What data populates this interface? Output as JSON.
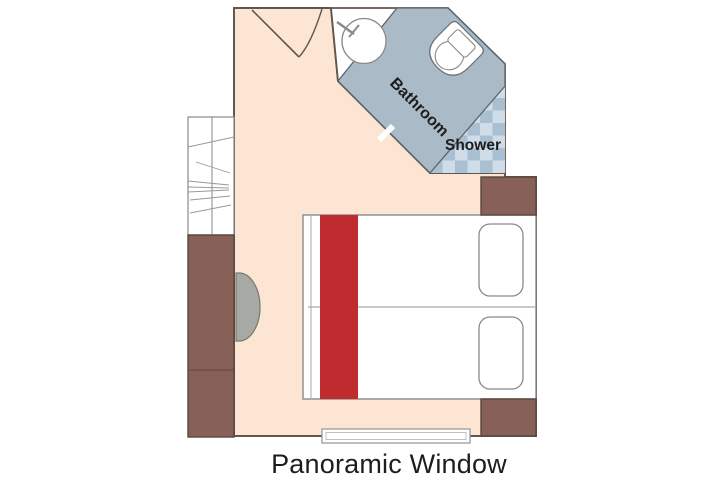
{
  "diagram": {
    "type": "cabin-floor-plan",
    "labels": {
      "bathroom": "Bathroom",
      "shower": "Shower",
      "window": "Panoramic Window"
    },
    "colors": {
      "background": "#ffffff",
      "floor": "#fce5d3",
      "bathroom_floor": "#aabbc7",
      "shower_tile_light": "#cfdde9",
      "shower_tile_dark": "#a9c0d3",
      "furniture_brown": "#876158",
      "bed_runner_red": "#bf2b2e",
      "bed_fill": "#ffffff",
      "stool_gray": "#a7a9a4",
      "wall_stroke": "#63564d",
      "fixture_stroke": "#8a8a8a",
      "label_text": "#1d1d1d"
    }
  }
}
